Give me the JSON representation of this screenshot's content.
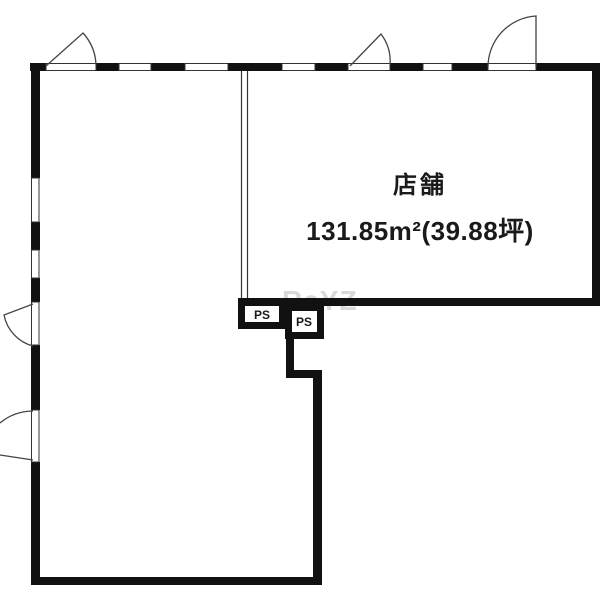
{
  "floorplan": {
    "room": {
      "name": "店舗",
      "area": "131.85m²(39.88坪)"
    },
    "pipe_spaces": [
      {
        "label": "PS"
      },
      {
        "label": "PS"
      }
    ],
    "watermark": "ReYZ",
    "colors": {
      "wall": "#111111",
      "background": "#ffffff",
      "door_line": "#444444",
      "thin_line": "#333333",
      "text": "#1a1a1a",
      "watermark": "#d9d9d9"
    }
  }
}
